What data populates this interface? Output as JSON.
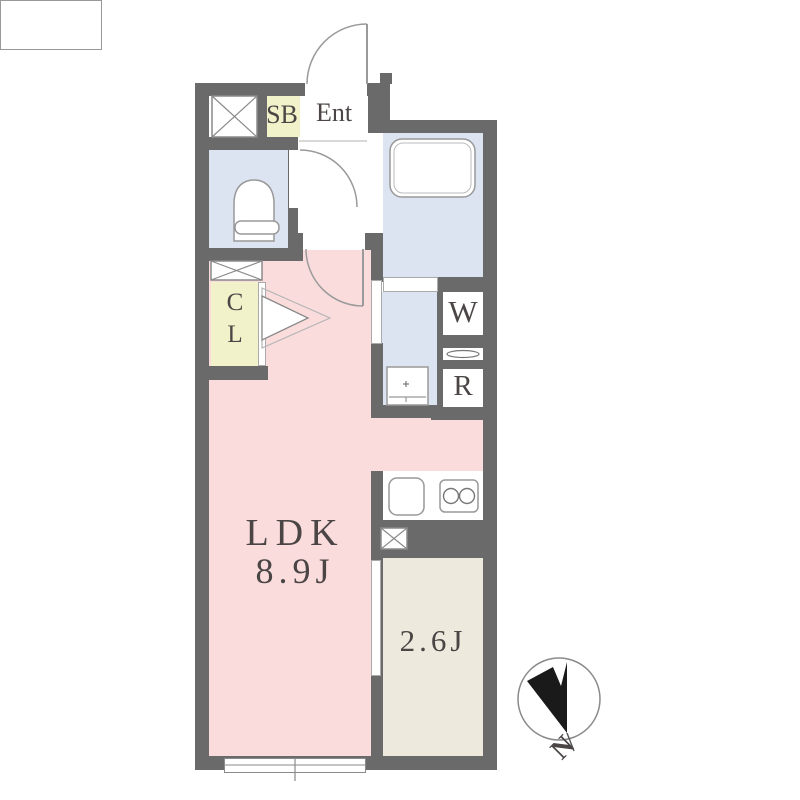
{
  "plan": {
    "labels": {
      "shoe_box": "SB",
      "entrance": "Ent",
      "closet_top": "C",
      "closet_bottom": "L",
      "ldk_name": "LDK",
      "ldk_size": "8.9J",
      "bedroom_size": "2.6J",
      "washer": "W",
      "refrigerator": "R",
      "compass_north": "N"
    },
    "colors": {
      "wall": "#6a6a6a",
      "ldk_floor": "#fadcdc",
      "wet_floor": "#dce4f1",
      "closet_floor": "#f1f1ca",
      "bedroom_floor": "#edeadd",
      "fixture_outline": "#999999",
      "label_text": "#4b4545",
      "compass_black": "#1a1a1a"
    }
  }
}
